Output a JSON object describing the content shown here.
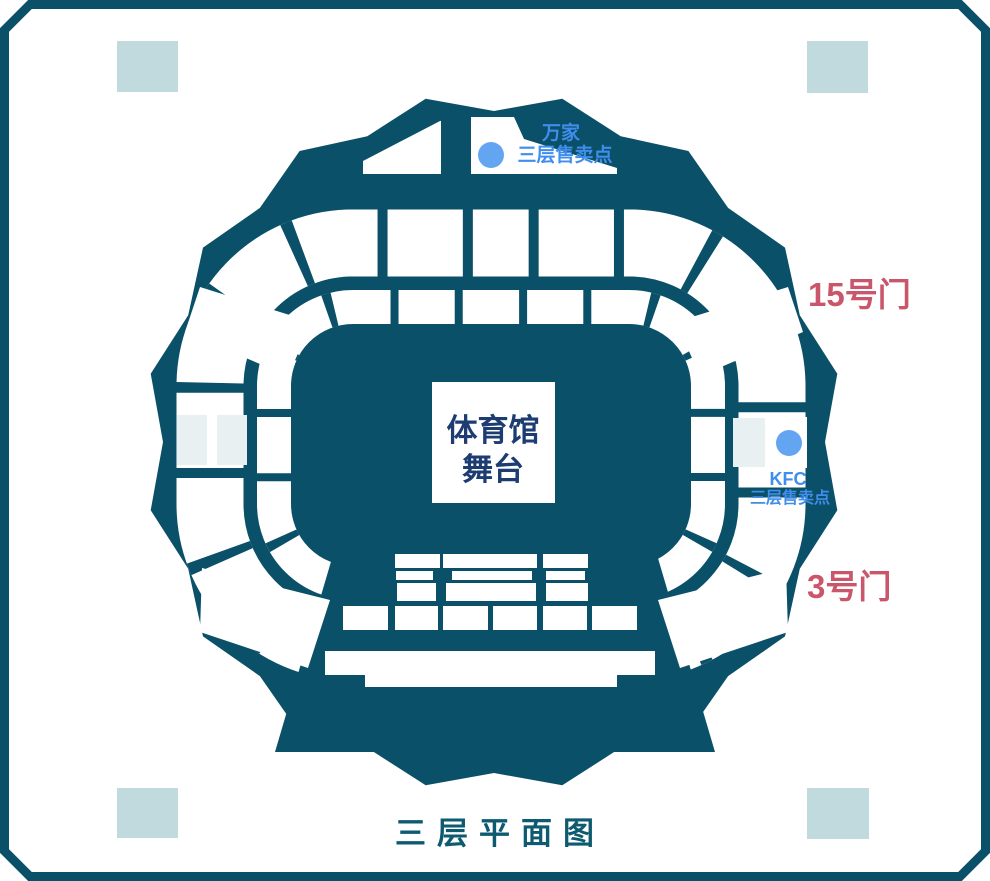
{
  "title": "三层平面图",
  "stage": {
    "line1": "体育馆",
    "line2": "舞台"
  },
  "gates": [
    {
      "id": "gate-15",
      "label": "15号门"
    },
    {
      "id": "gate-3",
      "label": "3号门"
    }
  ],
  "concessions": [
    {
      "id": "wanjia",
      "name": "万家",
      "type": "三层售卖点"
    },
    {
      "id": "kfc",
      "name": "KFC",
      "type": "三层售卖点"
    }
  ],
  "icons": {
    "concession_dot": "circle-marker"
  },
  "colors": {
    "primary": "#0a5068",
    "sectionWhite": "#ffffff",
    "cornerSquare": "#c1dade",
    "gateSection": "#e9f0f1",
    "dotBlue": "#64a5f2",
    "labelBlue": "#3f8dec",
    "gateRed": "#c9566b",
    "stageNavy": "#1c3c72",
    "titleTeal": "#0e5a70"
  }
}
